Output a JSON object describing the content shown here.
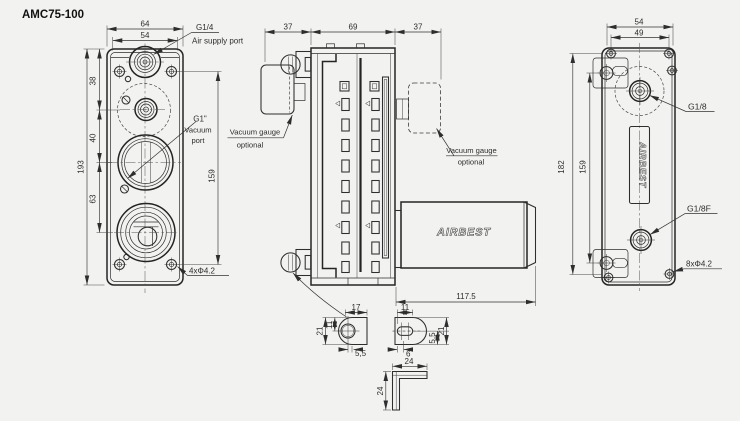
{
  "title": "AMC75-100",
  "colors": {
    "background": "#f2f2f0",
    "line": "#2e2e2e",
    "text": "#2d2d2d"
  },
  "front_view": {
    "dims": {
      "outer_width": "64",
      "inner_width": "54",
      "overall_height": "193",
      "seg_top": "38",
      "seg_mid": "40",
      "seg_bottom": "63",
      "screw_span": "159",
      "mount_holes": "4xΦ4.2"
    },
    "labels": {
      "air_thread": "G1/4",
      "air_port": "Air supply port",
      "vac_thread": "G1\"",
      "vac_word1": "Vacuum",
      "vac_word2": "port"
    }
  },
  "side_view": {
    "dims": {
      "left_depth": "37",
      "body_width": "69",
      "right_depth": "37",
      "silencer_length": "117.5"
    },
    "gauge_left": {
      "line1": "Vacuum gauge",
      "line2": "optional"
    },
    "gauge_right": {
      "line1": "Vacuum gauge",
      "line2": "optional"
    },
    "silencer_brand": "AIRBEST"
  },
  "rear_view": {
    "dims": {
      "outer_span": "54",
      "inner_span": "49",
      "overall_height": "182",
      "screw_span": "159",
      "mount_holes": "8xΦ4.2"
    },
    "labels": {
      "port_top": "G1/8",
      "port_bottom": "G1/8F"
    },
    "brand": "AIRBEST"
  },
  "details": {
    "bracket_a": {
      "width": "17",
      "height": "21",
      "hole_offset": "11",
      "edge": "5,5"
    },
    "bracket_b": {
      "slot_len": "11",
      "edge": "6",
      "side_small": "5,5",
      "height": "21"
    },
    "angle": {
      "width": "24",
      "height": "24"
    }
  }
}
